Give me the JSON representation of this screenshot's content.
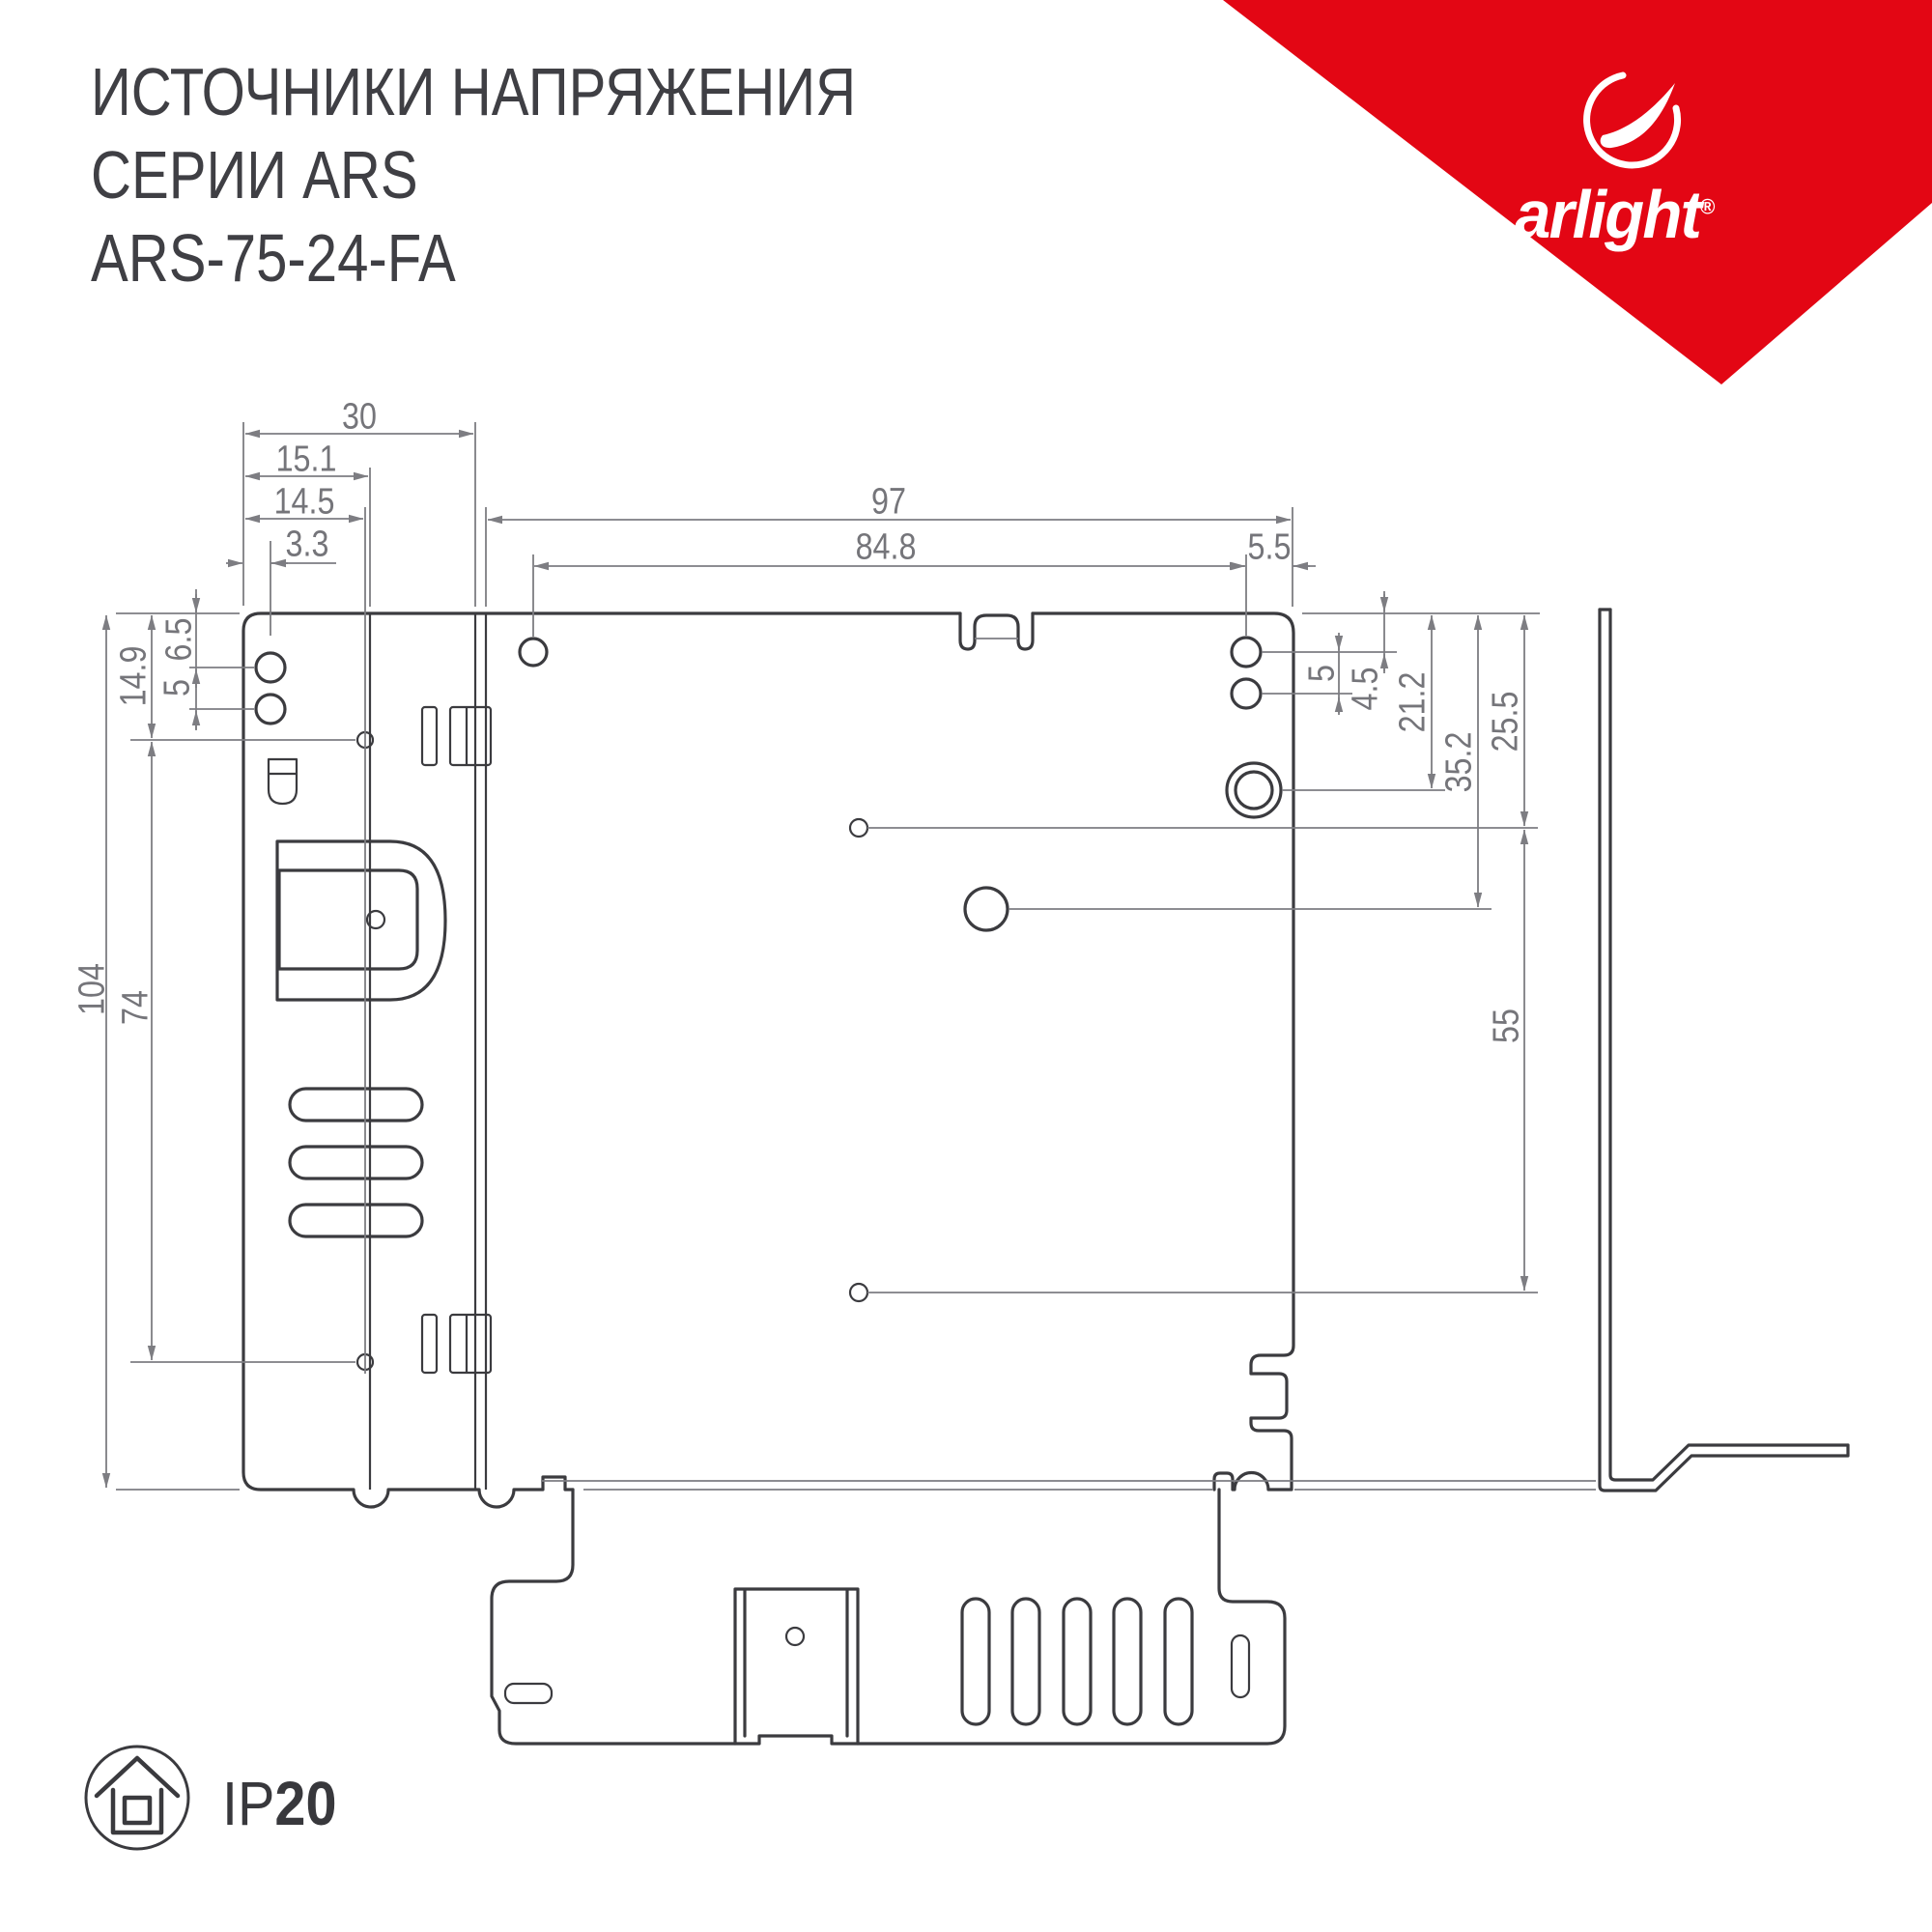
{
  "header": {
    "title_line1": "ИСТОЧНИКИ НАПРЯЖЕНИЯ",
    "title_line2": "СЕРИИ ARS",
    "title_line3": "ARS-75-24-FA"
  },
  "brand": {
    "name": "arlight",
    "registered": "®",
    "banner_color": "#e30614"
  },
  "drawing": {
    "line_color": "#3b3b3f",
    "dim_color": "#7d7d82",
    "dimensions": {
      "d30": "30",
      "d15_1": "15.1",
      "d14_5": "14.5",
      "d3_3": "3.3",
      "d97": "97",
      "d84_8": "84.8",
      "d5_5": "5.5",
      "d14_9": "14.9",
      "d6_5": "6.5",
      "d5l": "5",
      "d104": "104",
      "d74": "74",
      "d5r": "5",
      "d4_5": "4.5",
      "d21_2": "21.2",
      "d35_2": "35.2",
      "d25_5": "25.5",
      "d55": "55"
    }
  },
  "footer": {
    "ip_label": "IP",
    "ip_value": "20"
  }
}
